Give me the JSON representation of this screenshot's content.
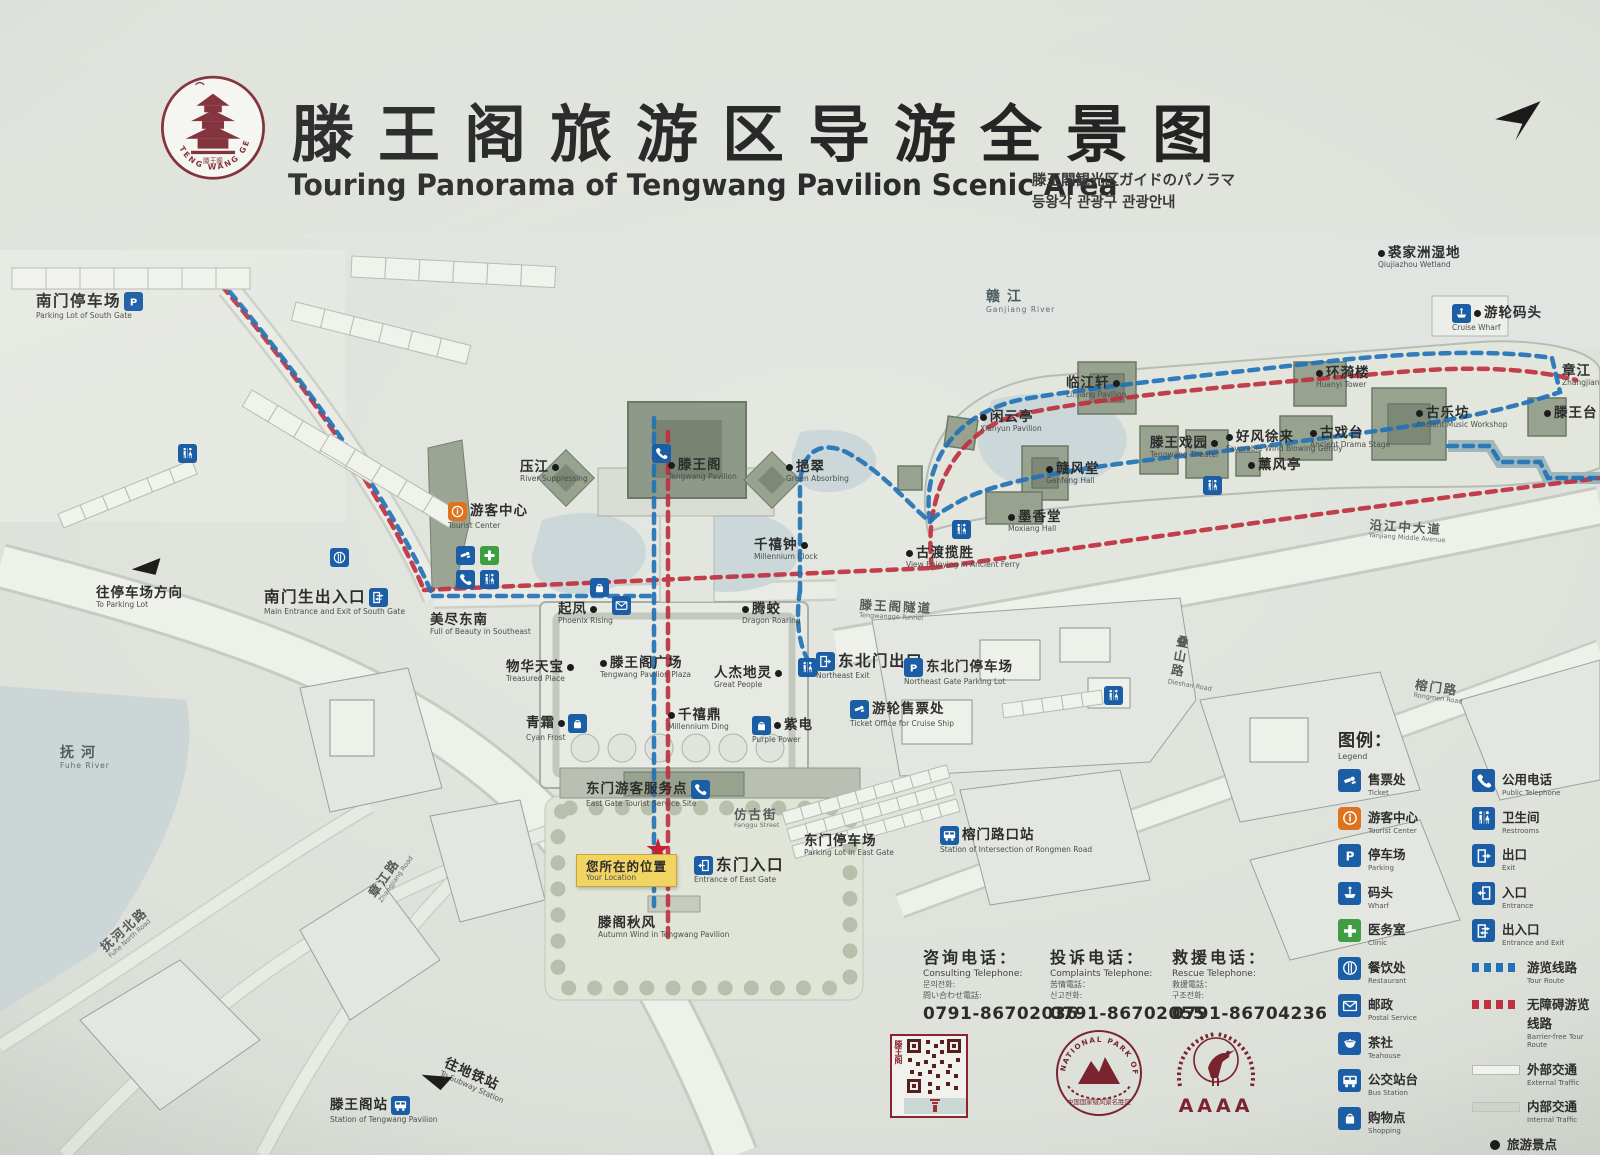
{
  "header": {
    "title_zh": "滕王阁旅游区导游全景图",
    "title_en": "Touring Panorama of Tengwang Pavilion Scenic Area",
    "title_ja": "滕王閣観光区ガイドのパノラマ",
    "title_ko": "등왕각 관광구 관광안내",
    "logo_text": "TENG WANG GE",
    "logo_seal": "滕王阁"
  },
  "colors": {
    "tour_route_blue": "#2273b6",
    "barrier_free_red": "#c1303f",
    "icon_blue": "#1b5ea6",
    "icon_orange": "#df721f",
    "icon_green": "#3f9e42",
    "location_yellow": "#f2d462",
    "brand_dark_red": "#8c2430"
  },
  "map": {
    "pois": [
      {
        "id": "south-gate-parking-lot",
        "zh": "南门停车场",
        "en": "Parking Lot of South Gate",
        "x": 36,
        "y": 292,
        "cls": "place big",
        "icons": [
          "parking"
        ],
        "icons_side": "r"
      },
      {
        "id": "to-parking-lot",
        "zh": "往停车场方向",
        "en": "To Parking Lot",
        "x": 96,
        "y": 586,
        "cls": "place"
      },
      {
        "id": "south-gate-main-entrance",
        "zh": "南门生出入口",
        "en": "Main Entrance and Exit of South Gate",
        "x": 264,
        "y": 588,
        "cls": "place big",
        "icons": [
          "inout"
        ],
        "icons_side": "r"
      },
      {
        "id": "tourist-center",
        "zh": "游客中心",
        "en": "Tourist Center",
        "x": 448,
        "y": 502,
        "cls": "place",
        "icons": [
          "info"
        ],
        "icons_side": "l"
      },
      {
        "id": "river-suppressing",
        "zh": "压江",
        "en": "River Suppressing",
        "x": 520,
        "y": 460,
        "cls": "place",
        "dot": "r"
      },
      {
        "id": "tengwang-pavilion",
        "zh": "滕王阁",
        "en": "Tengwang Pavilion",
        "x": 668,
        "y": 458,
        "cls": "place",
        "dot": "l"
      },
      {
        "id": "green-absorbing",
        "zh": "挹翠",
        "en": "Green Absorbing",
        "x": 786,
        "y": 460,
        "cls": "place",
        "dot": "l"
      },
      {
        "id": "full-of-beauty-southeast",
        "zh": "美尽东南",
        "en": "Full of Beauty in Southeast",
        "x": 430,
        "y": 613,
        "cls": "place"
      },
      {
        "id": "phoenix-rising",
        "zh": "起凤",
        "en": "Phoenix Rising",
        "x": 558,
        "y": 602,
        "cls": "place",
        "dot": "r"
      },
      {
        "id": "dragon-roaring",
        "zh": "腾蛟",
        "en": "Dragon Roaring",
        "x": 742,
        "y": 602,
        "cls": "place",
        "dot": "l"
      },
      {
        "id": "treasured-place",
        "zh": "物华天宝",
        "en": "Treasured Place",
        "x": 506,
        "y": 660,
        "cls": "place",
        "dot": "r"
      },
      {
        "id": "tengwang-pavilion-plaza",
        "zh": "滕王阁广场",
        "en": "Tengwang Pavilion Plaza",
        "x": 600,
        "y": 656,
        "cls": "place",
        "dot": "l"
      },
      {
        "id": "great-people",
        "zh": "人杰地灵",
        "en": "Great People",
        "x": 714,
        "y": 666,
        "cls": "place",
        "dot": "r"
      },
      {
        "id": "cyan-frost",
        "zh": "青霜",
        "en": "Cyan Frost",
        "x": 526,
        "y": 714,
        "cls": "place",
        "dot": "r",
        "icons": [
          "shopping"
        ],
        "icons_side": "r"
      },
      {
        "id": "millennium-ding",
        "zh": "千禧鼎",
        "en": "Millennium Ding",
        "x": 668,
        "y": 708,
        "cls": "place",
        "dot": "l"
      },
      {
        "id": "purple-power",
        "zh": "紫电",
        "en": "Purple Power",
        "x": 752,
        "y": 716,
        "cls": "place",
        "dot": "l",
        "icons": [
          "shopping"
        ],
        "icons_side": "l"
      },
      {
        "id": "millennium-clock",
        "zh": "千禧钟",
        "en": "Millennium Clock",
        "x": 754,
        "y": 538,
        "cls": "place",
        "dot": "r"
      },
      {
        "id": "ancient-ferry-view",
        "zh": "古渡揽胜",
        "en": "View Enjoying in Ancient Ferry",
        "x": 906,
        "y": 546,
        "cls": "place",
        "dot": "l"
      },
      {
        "id": "moxiang-hall",
        "zh": "墨香堂",
        "en": "Moxiang Hall",
        "x": 1008,
        "y": 510,
        "cls": "place",
        "dot": "l"
      },
      {
        "id": "xianyun-pavilion",
        "zh": "闲云亭",
        "en": "Xianyun Pavilion",
        "x": 980,
        "y": 410,
        "cls": "place",
        "dot": "l"
      },
      {
        "id": "linjiang-pavilion",
        "zh": "临江轩",
        "en": "Linjiang Pavilion",
        "x": 1066,
        "y": 376,
        "cls": "place",
        "dot": "r"
      },
      {
        "id": "ganfeng-hall",
        "zh": "赣风堂",
        "en": "Ganfeng Hall",
        "x": 1046,
        "y": 462,
        "cls": "place",
        "dot": "l"
      },
      {
        "id": "tengwang-theater",
        "zh": "滕王戏园",
        "en": "Tengwang Theater",
        "x": 1150,
        "y": 436,
        "cls": "place",
        "dot": "r"
      },
      {
        "id": "favorable-wind",
        "zh": "好风徐来",
        "en": "Favorable Wind Blowing Gently",
        "x": 1226,
        "y": 430,
        "cls": "place",
        "dot": "l"
      },
      {
        "id": "xunfeng-pavilion",
        "zh": "薰风亭",
        "en": "",
        "x": 1248,
        "y": 458,
        "cls": "place",
        "dot": "l"
      },
      {
        "id": "ancient-drama-stage",
        "zh": "古戏台",
        "en": "Ancient Drama Stage",
        "x": 1310,
        "y": 426,
        "cls": "place",
        "dot": "l"
      },
      {
        "id": "huanyi-tower",
        "zh": "环漪楼",
        "en": "Huanyi Tower",
        "x": 1316,
        "y": 366,
        "cls": "place",
        "dot": "l"
      },
      {
        "id": "ancient-music-workshop",
        "zh": "古乐坊",
        "en": "Ancient Music Workshop",
        "x": 1416,
        "y": 406,
        "cls": "place",
        "dot": "l"
      },
      {
        "id": "tengwang-terrace",
        "zh": "滕王台",
        "en": "",
        "x": 1544,
        "y": 406,
        "cls": "place",
        "dot": "l"
      },
      {
        "id": "zhangjiang",
        "zh": "章江",
        "en": "Zhangjiang",
        "x": 1562,
        "y": 364,
        "cls": "place"
      },
      {
        "id": "qiujiazhou-wetland",
        "zh": "裘家洲湿地",
        "en": "Qiujiazhou Wetland",
        "x": 1378,
        "y": 246,
        "cls": "place",
        "dot": "l"
      },
      {
        "id": "cruise-wharf",
        "zh": "游轮码头",
        "en": "Cruise Wharf",
        "x": 1452,
        "y": 304,
        "cls": "place",
        "dot": "l",
        "icons": [
          "wharf"
        ],
        "icons_side": "l"
      },
      {
        "id": "ganjiang-river",
        "zh": "赣江",
        "en": "Ganjiang River",
        "x": 986,
        "y": 290,
        "cls": "water"
      },
      {
        "id": "northeast-exit",
        "zh": "东北门出口",
        "en": "Northeast Exit",
        "x": 816,
        "y": 652,
        "cls": "place big",
        "icons": [
          "exit"
        ],
        "icons_side": "l"
      },
      {
        "id": "northeast-gate-parking-lot",
        "zh": "东北门停车场",
        "en": "Northeast Gate Parking Lot",
        "x": 904,
        "y": 658,
        "cls": "place",
        "icons": [
          "parking"
        ],
        "icons_side": "l"
      },
      {
        "id": "cruise-ticket-office",
        "zh": "游轮售票处",
        "en": "Ticket Office for Cruise Ship",
        "x": 850,
        "y": 700,
        "cls": "place",
        "icons": [
          "ticket"
        ],
        "icons_side": "l"
      },
      {
        "id": "tengwangge-tunnel",
        "zh": "滕王阁隧道",
        "en": "Tengwangge Tunnel",
        "x": 860,
        "y": 598,
        "cls": "road",
        "rot": 3
      },
      {
        "id": "east-gate-service-site",
        "zh": "东门游客服务点",
        "en": "East Gate Tourist Service Site",
        "x": 586,
        "y": 780,
        "cls": "place",
        "icons": [
          "phone"
        ],
        "icons_side": "r"
      },
      {
        "id": "fanggu-street",
        "zh": "仿古街",
        "en": "Fanggu Street",
        "x": 734,
        "y": 808,
        "cls": "road"
      },
      {
        "id": "east-gate-parking-lot",
        "zh": "东门停车场",
        "en": "Parking Lot in East Gate",
        "x": 804,
        "y": 834,
        "cls": "place"
      },
      {
        "id": "your-location",
        "zh": "您所在的位置",
        "en": "Your Location",
        "x": 576,
        "y": 854,
        "cls": "callout"
      },
      {
        "id": "east-gate-entrance",
        "zh": "东门入口",
        "en": "Entrance of East Gate",
        "x": 694,
        "y": 856,
        "cls": "place big",
        "icons": [
          "entrance"
        ],
        "icons_side": "l"
      },
      {
        "id": "autumn-wind",
        "zh": "滕阁秋风",
        "en": "Autumn Wind in Tengwang Pavilion",
        "x": 598,
        "y": 916,
        "cls": "place"
      },
      {
        "id": "rongmen-crossing-station",
        "zh": "榕门路口站",
        "en": "Station of Intersection of Rongmen Road",
        "x": 940,
        "y": 826,
        "cls": "place",
        "icons": [
          "bus"
        ],
        "icons_side": "l"
      },
      {
        "id": "yanjiang-middle-avenue",
        "zh": "沿江中大道",
        "en": "Yanjiang Middle Avenue",
        "x": 1370,
        "y": 518,
        "cls": "road",
        "rot": 4
      },
      {
        "id": "rongmen-road",
        "zh": "榕门路",
        "en": "Rongmen Road",
        "x": 1416,
        "y": 678,
        "cls": "road",
        "rot": 8
      },
      {
        "id": "dieshan-road",
        "zh": "叠山路",
        "en": "Dieshan Road",
        "x": 1176,
        "y": 634,
        "cls": "road vertical",
        "rot": 10
      },
      {
        "id": "fuhe-river",
        "zh": "抚河",
        "en": "Fuhe River",
        "x": 60,
        "y": 746,
        "cls": "water"
      },
      {
        "id": "fuhe-north-road",
        "zh": "抚河北路",
        "en": "Fuhe North Road",
        "x": 98,
        "y": 944,
        "cls": "road",
        "rot": -42
      },
      {
        "id": "zhangjiang-road",
        "zh": "章江路",
        "en": "Zhangjiang Road",
        "x": 366,
        "y": 892,
        "cls": "road",
        "rot": -55
      },
      {
        "id": "tengwang-pavilion-station",
        "zh": "滕王阁站",
        "en": "Station of Tengwang Pavilion",
        "x": 330,
        "y": 1096,
        "cls": "place",
        "icons": [
          "bus"
        ],
        "icons_side": "r"
      },
      {
        "id": "to-subway-station",
        "zh": "往地铁站",
        "en": "To Subway Station",
        "x": 448,
        "y": 1056,
        "cls": "place",
        "rot": 24
      }
    ],
    "facilities": [
      {
        "icon": "restroom",
        "x": 178,
        "y": 444
      },
      {
        "icon": "restaurant",
        "x": 330,
        "y": 548
      },
      {
        "icon": "ticket",
        "x": 456,
        "y": 546
      },
      {
        "icon": "medical",
        "x": 480,
        "y": 546
      },
      {
        "icon": "phone",
        "x": 456,
        "y": 570
      },
      {
        "icon": "restroom",
        "x": 480,
        "y": 570
      },
      {
        "icon": "shopping",
        "x": 590,
        "y": 578
      },
      {
        "icon": "mail",
        "x": 612,
        "y": 596
      },
      {
        "icon": "phone",
        "x": 652,
        "y": 444
      },
      {
        "icon": "restroom",
        "x": 798,
        "y": 658
      },
      {
        "icon": "restroom",
        "x": 952,
        "y": 520
      },
      {
        "icon": "restroom",
        "x": 1104,
        "y": 686
      },
      {
        "icon": "restroom",
        "x": 1203,
        "y": 476
      },
      {
        "icon": "star",
        "x": 646,
        "y": 838
      },
      {
        "icon": "arrow-sw",
        "x": 132,
        "y": 560,
        "rot": -8
      },
      {
        "icon": "arrow-sw",
        "x": 420,
        "y": 1072,
        "rot": 18
      }
    ]
  },
  "legend": {
    "title_zh": "图例：",
    "title_en": "Legend",
    "items_left": [
      {
        "icon": "ticket",
        "zh": "售票处",
        "en": "Ticket"
      },
      {
        "icon": "info",
        "zh": "游客中心",
        "en": "Tourist Center"
      },
      {
        "icon": "parking",
        "zh": "停车场",
        "en": "Parking"
      },
      {
        "icon": "wharf",
        "zh": "码头",
        "en": "Wharf"
      },
      {
        "icon": "medical",
        "zh": "医务室",
        "en": "Clinic"
      },
      {
        "icon": "restaurant",
        "zh": "餐饮处",
        "en": "Restaurant"
      },
      {
        "icon": "mail",
        "zh": "邮政",
        "en": "Postal Service"
      },
      {
        "icon": "teahouse",
        "zh": "茶社",
        "en": "Teahouse"
      },
      {
        "icon": "bus",
        "zh": "公交站台",
        "en": "Bus Station"
      },
      {
        "icon": "shopping",
        "zh": "购物点",
        "en": "Shopping"
      }
    ],
    "items_right": [
      {
        "icon": "phone",
        "zh": "公用电话",
        "en": "Public Telephone"
      },
      {
        "icon": "restroom",
        "zh": "卫生间",
        "en": "Restrooms"
      },
      {
        "icon": "exit",
        "zh": "出口",
        "en": "Exit"
      },
      {
        "icon": "entrance",
        "zh": "入口",
        "en": "Entrance"
      },
      {
        "icon": "inout",
        "zh": "出入口",
        "en": "Entrance and Exit"
      },
      {
        "swatch": "dash-blue",
        "zh": "游览线路",
        "en": "Tour Route"
      },
      {
        "swatch": "dash-red",
        "zh": "无障碍游览线路",
        "en": "Barrier-free Tour Route"
      },
      {
        "swatch": "bar-light",
        "zh": "外部交通",
        "en": "External Traffic"
      },
      {
        "swatch": "bar-gray",
        "zh": "内部交通",
        "en": "Internal Traffic"
      },
      {
        "swatch": "dotmark",
        "zh": "旅游景点",
        "en": "Tourist Attractions"
      },
      {
        "swatch": "star",
        "zh": "您所在的位置",
        "en": "Your Location"
      }
    ]
  },
  "phones": [
    {
      "zh": "咨询电话：",
      "en": "Consulting Telephone:",
      "l3": "문의전화:",
      "l4": "問い合わせ電話:",
      "num": "0791-86702036",
      "x": 923,
      "y": 944
    },
    {
      "zh": "投诉电话：",
      "en": "Complaints Telephone:",
      "l3": "苦情電話：",
      "l4": "신고전화:",
      "num": "0791-86702055",
      "x": 1050,
      "y": 944
    },
    {
      "zh": "救援电话：",
      "en": "Rescue Telephone:",
      "l3": "救援電話：",
      "l4": "구조전화:",
      "num": "0791-86704236",
      "x": 1172,
      "y": 944
    }
  ],
  "footer": {
    "qr_caption": "滕王阁",
    "seal_ring": "NATIONAL PARK OF CHINA",
    "seal_caption": "中国国家级风景名胜区",
    "aaaa": "AAAA"
  }
}
